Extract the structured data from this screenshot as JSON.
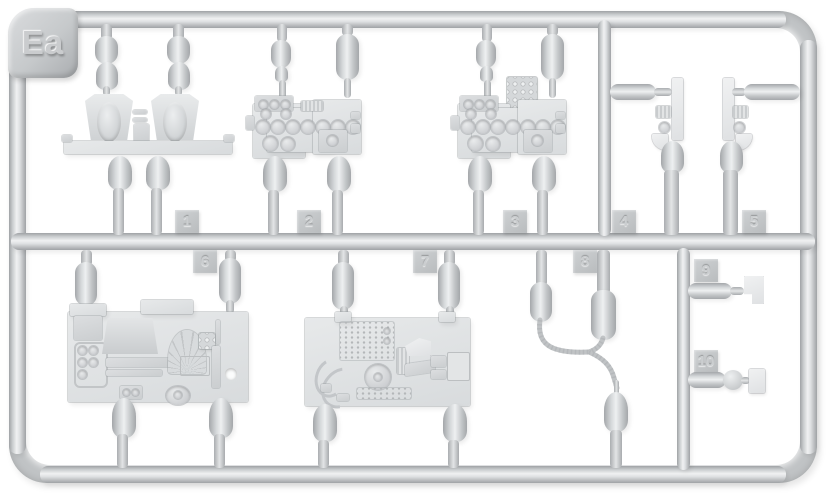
{
  "sprue": {
    "frame_label": "Ea",
    "tags": [
      "1",
      "2",
      "3",
      "4",
      "5",
      "6",
      "7",
      "8",
      "9",
      "10"
    ],
    "colors": {
      "background": "#ffffff",
      "plastic_mid": "#d4d7d9",
      "plastic_highlight": "#f0f1f2",
      "plastic_shadow": "#9fa2a5"
    }
  }
}
